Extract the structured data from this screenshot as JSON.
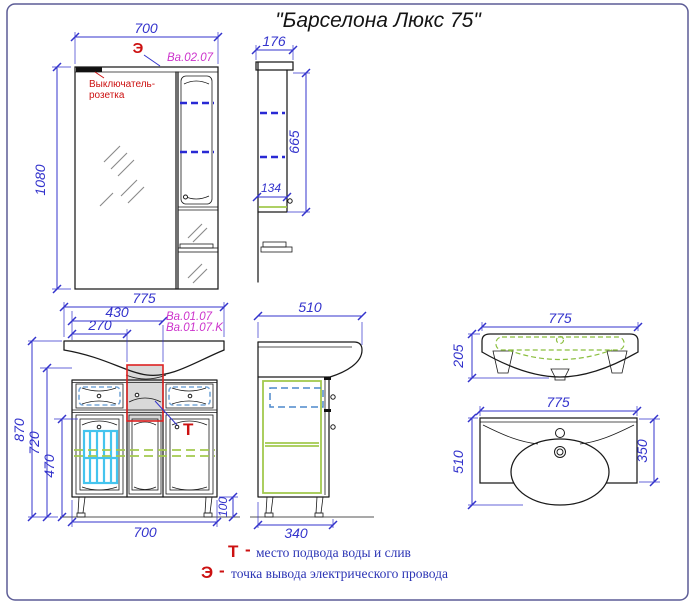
{
  "title": "\"Барселона Люкс 75\"",
  "mirror_front": {
    "width": "700",
    "height": "1080",
    "code": "Ba.02.07",
    "electric_symbol": "Э",
    "switch_label_line1": "Выключатель-",
    "switch_label_line2": "розетка"
  },
  "mirror_side": {
    "depth": "176",
    "body_height": "665",
    "shelf_depth": "134"
  },
  "vanity_front": {
    "sink_width": "775",
    "dim_to_column_right": "430",
    "dim_to_column_left": "270",
    "total_height": "870",
    "body_height": "720",
    "door_height": "470",
    "cabinet_width": "700",
    "leg_height": "100",
    "code_line1": "Ba.01.07",
    "code_line2": "Ba.01.07.K",
    "water_symbol": "Т"
  },
  "vanity_side": {
    "total_depth": "510",
    "cabinet_depth": "340"
  },
  "washbasin_front": {
    "width": "775",
    "height": "205"
  },
  "washbasin_top": {
    "width": "775",
    "total_depth": "510",
    "body_depth": "350"
  },
  "legend": {
    "water_symbol": "Т",
    "water_dash": "-",
    "water_text": "место подвода воды и слив",
    "electric_symbol": "Э",
    "electric_dash": "-",
    "electric_text": "точка вывода электрического провода"
  },
  "colors": {
    "dimension_blue": "#3333cc",
    "outline_black": "#1a1a1a",
    "accent_red": "#cc1111",
    "code_magenta": "#cc33cc",
    "shelf_green": "#a2c94e",
    "basket_cyan": "#44c4ee",
    "highlight_gray": "#d9d9d9",
    "highlight_red": "#dd2222"
  }
}
